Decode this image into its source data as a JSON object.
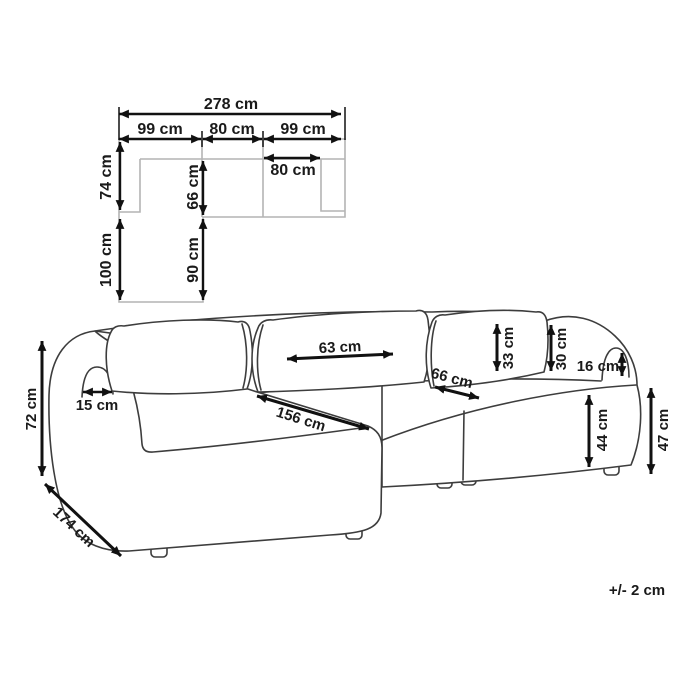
{
  "plan": {
    "total_width": "278 cm",
    "module_left_width": "99 cm",
    "module_middle_width": "80 cm",
    "module_right_width": "99 cm",
    "right_seat_width": "80 cm",
    "back_section_depth": "74 cm",
    "chaise_front_depth": "100 cm",
    "seat_depth": "66 cm",
    "chaise_extension": "90 cm"
  },
  "sofa": {
    "overall_height": "72 cm",
    "chaise_total_depth": "174 cm",
    "armrest_width": "15 cm",
    "back_cushion_width": "63 cm",
    "chaise_length": "156 cm",
    "seat_depth": "66 cm",
    "back_cushion_height": "33 cm",
    "backrest_height": "30 cm",
    "armrest_above_backrest": "16 cm",
    "seat_height": "44 cm",
    "armrest_height": "47 cm"
  },
  "note": {
    "tolerance": "+/- 2 cm"
  },
  "colors": {
    "sofa_outline": "#3d3d3d",
    "plan_outline": "#b4b4b4",
    "arrow": "#111111",
    "background": "#ffffff"
  }
}
